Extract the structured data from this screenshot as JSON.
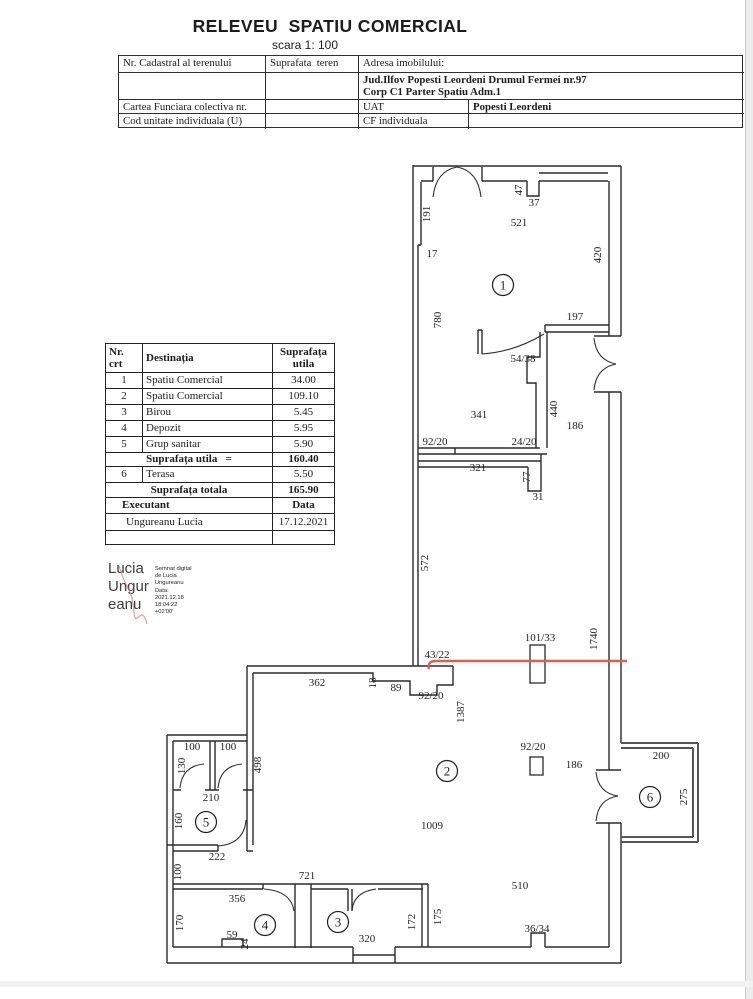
{
  "page": {
    "title": "RELEVEU  SPATIU COMERCIAL",
    "scale": "scara 1: 100"
  },
  "info_table": {
    "cadastral_label": "Nr. Cadastral al terenului",
    "surface_label": "Suprafata  teren",
    "address_label": "Adresa imobilului:",
    "address_line1": "Jud.Ilfov  Popesti Leordeni Drumul Fermei nr.97",
    "address_line2": "Corp C1 Parter  Spatiu Adm.1",
    "cf_label": "Cartea Funciara colectiva nr.",
    "uat_label": "UAT",
    "uat_value": "Popesti Leordeni",
    "unit_label": "Cod unitate  individuala (U)",
    "cf_individual_label": "CF individuala"
  },
  "area_table": {
    "header_nr": "Nr.\ncrt",
    "header_dest": "Destinația",
    "header_sup": "Suprafața\nutila",
    "rows": [
      {
        "nr": "1",
        "dest": "Spatiu Comercial",
        "sup": "34.00"
      },
      {
        "nr": "2",
        "dest": "Spatiu Comercial",
        "sup": "109.10"
      },
      {
        "nr": "3",
        "dest": "Birou",
        "sup": "5.45"
      },
      {
        "nr": "4",
        "dest": "Depozit",
        "sup": "5.95"
      },
      {
        "nr": "5",
        "dest": "Grup sanitar",
        "sup": "5.90"
      }
    ],
    "subtotal_label": "Suprafața utila   =",
    "subtotal_value": "160.40",
    "terasa_row": {
      "nr": "6",
      "dest": "Terasa",
      "sup": "5.50"
    },
    "total_label": "Suprafața totala",
    "total_value": "165.90",
    "executant_label": "Executant",
    "data_label": "Data",
    "executant_value": "Ungureanu  Lucia",
    "data_value": "17.12.2021"
  },
  "signature": {
    "big_lines": [
      "Lucia",
      "Ungur",
      "eanu"
    ],
    "small_lines": [
      "Semnat digital",
      "de Lucia",
      "Ungureanu",
      "Data:",
      "2021.12.18",
      "18:04:22",
      "+02'00'"
    ]
  },
  "floorplan": {
    "red_line_color": "#d7604e",
    "rooms": [
      {
        "n": "1",
        "x": 503,
        "y": 285
      },
      {
        "n": "2",
        "x": 447,
        "y": 771
      },
      {
        "n": "3",
        "x": 338,
        "y": 922
      },
      {
        "n": "4",
        "x": 265,
        "y": 925
      },
      {
        "n": "5",
        "x": 206,
        "y": 822
      },
      {
        "n": "6",
        "x": 650,
        "y": 797
      }
    ],
    "labels": [
      {
        "t": "191",
        "x": 430,
        "y": 214,
        "r": -90
      },
      {
        "t": "17",
        "x": 432,
        "y": 257
      },
      {
        "t": "521",
        "x": 519,
        "y": 226
      },
      {
        "t": "47",
        "x": 522,
        "y": 190,
        "r": -90
      },
      {
        "t": "37",
        "x": 534,
        "y": 206
      },
      {
        "t": "420",
        "x": 601,
        "y": 255,
        "r": -90
      },
      {
        "t": "780",
        "x": 441,
        "y": 320,
        "r": -90
      },
      {
        "t": "197",
        "x": 575,
        "y": 320
      },
      {
        "t": "54/38",
        "x": 523,
        "y": 362
      },
      {
        "t": "341",
        "x": 479,
        "y": 418
      },
      {
        "t": "440",
        "x": 557,
        "y": 409,
        "r": -90
      },
      {
        "t": "186",
        "x": 575,
        "y": 429
      },
      {
        "t": "92/20",
        "x": 435,
        "y": 445
      },
      {
        "t": "24/20",
        "x": 524,
        "y": 445
      },
      {
        "t": "321",
        "x": 478,
        "y": 471
      },
      {
        "t": "77",
        "x": 530,
        "y": 477,
        "r": -90
      },
      {
        "t": "31",
        "x": 538,
        "y": 500
      },
      {
        "t": "572",
        "x": 428,
        "y": 563,
        "r": -90
      },
      {
        "t": "101/33",
        "x": 540,
        "y": 641
      },
      {
        "t": "1740",
        "x": 597,
        "y": 639,
        "r": -90
      },
      {
        "t": "43/22",
        "x": 437,
        "y": 658
      },
      {
        "t": "362",
        "x": 317,
        "y": 686
      },
      {
        "t": "18",
        "x": 376,
        "y": 683,
        "r": -90
      },
      {
        "t": "89",
        "x": 396,
        "y": 691
      },
      {
        "t": "92/20",
        "x": 431,
        "y": 699
      },
      {
        "t": "1387",
        "x": 464,
        "y": 712,
        "r": -90
      },
      {
        "t": "92/20",
        "x": 533,
        "y": 750
      },
      {
        "t": "186",
        "x": 574,
        "y": 768
      },
      {
        "t": "200",
        "x": 661,
        "y": 759
      },
      {
        "t": "275",
        "x": 687,
        "y": 797,
        "r": -90
      },
      {
        "t": "1009",
        "x": 432,
        "y": 829
      },
      {
        "t": "100",
        "x": 192,
        "y": 750
      },
      {
        "t": "100",
        "x": 228,
        "y": 750
      },
      {
        "t": "130",
        "x": 185,
        "y": 766,
        "r": -90
      },
      {
        "t": "498",
        "x": 261,
        "y": 765,
        "r": -90
      },
      {
        "t": "210",
        "x": 211,
        "y": 801
      },
      {
        "t": "160",
        "x": 182,
        "y": 821,
        "r": -90
      },
      {
        "t": "222",
        "x": 217,
        "y": 860
      },
      {
        "t": "100",
        "x": 181,
        "y": 872,
        "r": -90
      },
      {
        "t": "721",
        "x": 307,
        "y": 879
      },
      {
        "t": "356",
        "x": 237,
        "y": 902
      },
      {
        "t": "170",
        "x": 183,
        "y": 923,
        "r": -90
      },
      {
        "t": "59",
        "x": 232,
        "y": 938
      },
      {
        "t": "24",
        "x": 248,
        "y": 944,
        "r": -90
      },
      {
        "t": "320",
        "x": 367,
        "y": 942
      },
      {
        "t": "172",
        "x": 415,
        "y": 922,
        "r": -90
      },
      {
        "t": "175",
        "x": 441,
        "y": 917,
        "r": -90
      },
      {
        "t": "510",
        "x": 520,
        "y": 889
      },
      {
        "t": "36/34",
        "x": 537,
        "y": 932
      }
    ]
  }
}
